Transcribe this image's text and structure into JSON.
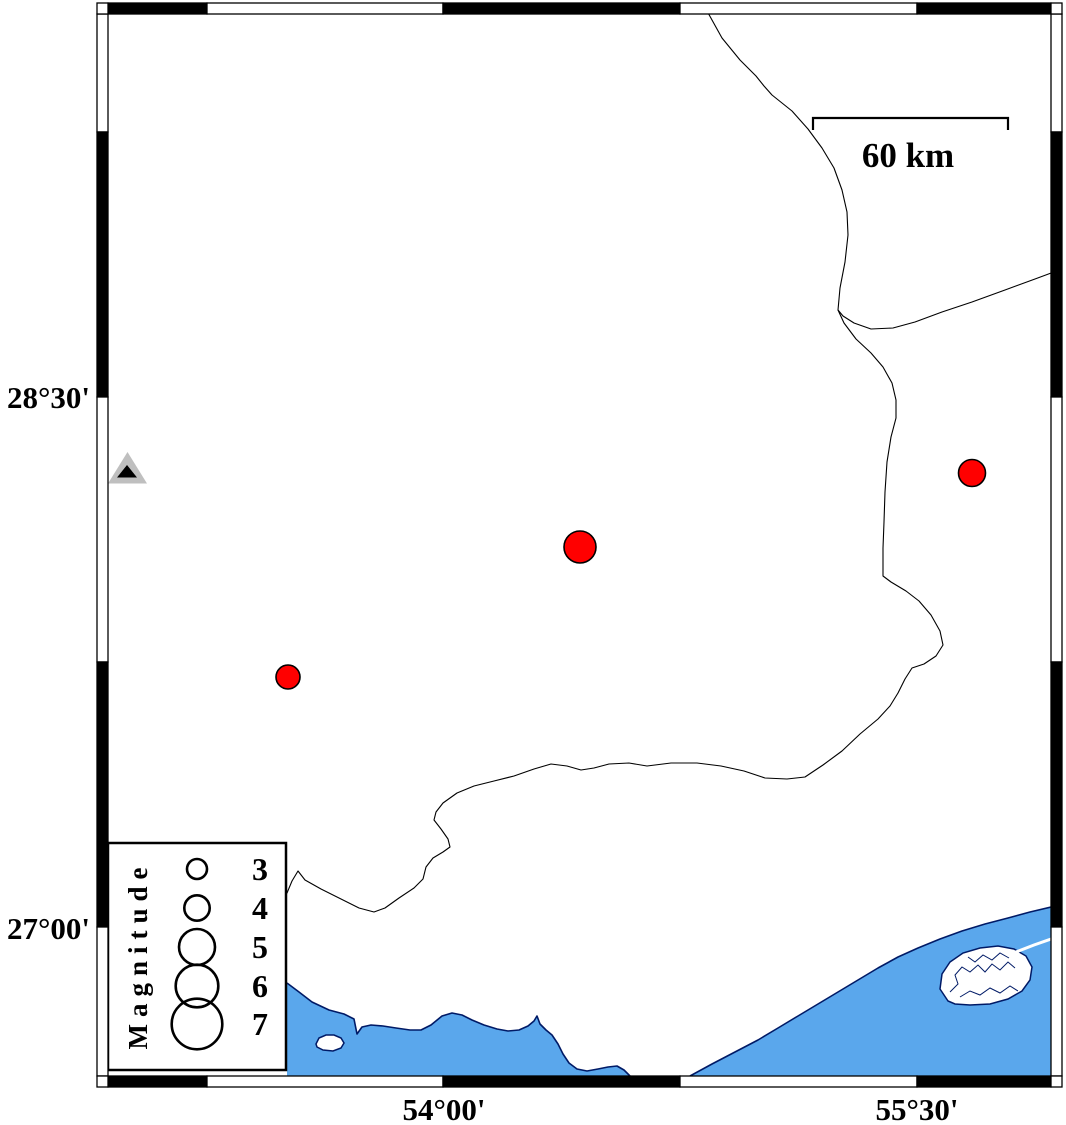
{
  "figure": {
    "width": 1066,
    "height": 1125,
    "background": "#FFFFFF"
  },
  "axis": {
    "lat_labels": [
      {
        "text": "28°30'"
      },
      {
        "text": "27°00'"
      }
    ],
    "lon_labels": [
      {
        "text": "54°00'"
      },
      {
        "text": "55°30'"
      }
    ]
  },
  "scalebar": {
    "label": "60 km"
  },
  "legend": {
    "title": "Magnitude",
    "circle_cx": 197,
    "label_x": 260,
    "entries": [
      {
        "label": "3",
        "cy": 869,
        "r": 10.0
      },
      {
        "label": "4",
        "cy": 908,
        "r": 12.7
      },
      {
        "label": "5",
        "cy": 947,
        "r": 18.0
      },
      {
        "label": "6",
        "cy": 986,
        "r": 21.3
      },
      {
        "label": "7",
        "cy": 1024,
        "r": 25.3
      }
    ]
  },
  "earthquakes": [
    {
      "x": 288,
      "y": 677,
      "r": 12.0
    },
    {
      "x": 580,
      "y": 547,
      "r": 16.0
    },
    {
      "x": 972,
      "y": 473,
      "r": 13.5
    }
  ],
  "station": {
    "x": 127.5,
    "y": 471
  },
  "colors": {
    "sea": "#5AA7EC",
    "coast_outline": "#001A66",
    "earthquake_fill": "#FF0000",
    "earthquake_stroke": "#000000",
    "station_gray": "#BFBFBF",
    "station_black": "#000000",
    "frame_black": "#000000",
    "frame_white": "#FFFFFF"
  },
  "frame": {
    "x_bounds": [
      108,
      207,
      443,
      680,
      917,
      1051
    ],
    "x_colors": [
      "black",
      "white",
      "black",
      "white",
      "black"
    ],
    "y_bounds": [
      14,
      132,
      397,
      662,
      927,
      1076
    ],
    "y_colors": [
      "white",
      "black",
      "white",
      "black",
      "white"
    ],
    "band": {
      "outer_left": 97,
      "inner_left": 108,
      "outer_top": 3,
      "inner_top": 14,
      "inner_right": 1051,
      "outer_right": 1062,
      "inner_bottom": 1076,
      "outer_bottom": 1087
    }
  },
  "paths": {
    "border_main": "M 707 11 L 722 38 L 740 60 L 756 76 L 764 86 L 772 95 L 792 111 L 808 129 L 822 148 L 834 168 L 842 190 L 847 212 L 848 235 L 845 262 L 840 288 L 838 310 L 844 323 L 856 339 L 871 353 L 883 367 L 892 383 L 896 400 L 896 418 L 891 437 L 887 462 L 885 492 L 884 522 L 883 548 L 883 576 L 891 582 L 906 591 L 919 601 L 931 615 L 940 631 L 943 645 L 936 656 L 924 664 L 912 668 L 905 679 L 898 693 L 890 706 L 878 719 L 860 734 L 842 751 L 823 765 L 805 777 L 787 779 L 765 778 L 744 771 L 721 766 L 697 763 L 671 763 L 647 766 L 629 763 L 609 764 L 594 768 L 581 770 L 567 766 L 551 764 L 534 769 L 514 776 L 494 781 L 474 786 L 457 793 L 443 803 L 436 812 L 434 820 L 441 829 L 448 839 L 450 847 L 443 852 L 433 858 L 426 867 L 423 879 L 414 888 L 399 898 L 385 908 L 374 912 L 359 908 L 341 899 L 321 889 L 305 880 L 298 871 L 292 881 L 287 893 L 283 890",
    "border_east": "M 1062 269 L 1035 279 L 1005 290 L 972 302 L 942 312 L 915 322 L 893 328 L 871 329 L 854 323 L 843 316 L 838 310",
    "sea_left": "M 287 983 L 299 992 L 312 1002 L 329 1010 L 344 1014 L 354 1019 L 357 1034 L 362 1027 L 371 1025 L 383 1026 L 396 1028 L 410 1030 L 421 1030 L 431 1025 L 442 1016 L 452 1013 L 462 1015 L 472 1020 L 484 1025 L 497 1029 L 508 1031 L 519 1030 L 528 1026 L 534 1021 L 537 1016 L 540 1024 L 546 1030 L 552 1035 L 558 1044 L 563 1054 L 569 1063 L 577 1069 L 587 1071 L 598 1069 L 608 1067 L 617 1066 L 624 1070 L 630 1076 L 287 1076 Z",
    "coast_left": "M 287 983 L 299 992 L 312 1002 L 329 1010 L 344 1014 L 354 1019 L 357 1034 L 362 1027 L 371 1025 L 383 1026 L 396 1028 L 410 1030 L 421 1030 L 431 1025 L 442 1016 L 452 1013 L 462 1015 L 472 1020 L 484 1025 L 497 1029 L 508 1031 L 519 1030 L 528 1026 L 534 1021 L 537 1016 L 540 1024 L 546 1030 L 552 1035 L 558 1044 L 563 1054 L 569 1063 L 577 1069 L 587 1071 L 598 1069 L 608 1067 L 617 1066 L 624 1070 L 630 1076",
    "island_left": "M 316 1044 L 319 1038 L 326 1035 L 334 1035 L 341 1038 L 344 1043 L 341 1048 L 333 1051 L 323 1050 L 317 1047 Z",
    "sea_right": "M 690 1076 L 712 1064 L 735 1052 L 758 1040 L 778 1028 L 798 1016 L 818 1004 L 838 992 L 858 980 L 878 968 L 898 957 L 918 948 L 940 939 L 962 931 L 985 924 L 1008 918 L 1030 912 L 1051 907 L 1051 1076 Z",
    "coast_right": "M 690 1076 L 712 1064 L 735 1052 L 758 1040 L 778 1028 L 798 1016 L 818 1004 L 838 992 L 858 980 L 878 968 L 898 957 L 918 948 L 940 939 L 962 931 L 985 924 L 1008 918 L 1030 912 L 1051 907",
    "island_right": "M 948 1001 L 940 989 L 942 974 L 950 962 L 963 953 L 980 948 L 998 946 L 1014 949 L 1026 956 L 1032 967 L 1030 980 L 1022 991 L 1008 999 L 990 1004 L 970 1005 L 955 1004 Z",
    "channel": "M 1051 939 L 1034 945 L 1016 952",
    "squiggle1": "M 950 992 L 958 984 L 955 975 L 962 967 L 970 972 L 978 965 L 985 972 L 992 964 L 1000 970 L 1008 962 L 1015 968",
    "squiggle2": "M 960 997 L 970 991 L 980 995 L 990 988 L 1000 993 L 1010 986 L 1018 991",
    "squiggle3": "M 968 957 L 975 962 L 983 955 L 992 960 L 1000 953 L 1009 958",
    "scalebar": "M 813 130 L 813 118 L 1008 118 L 1008 130"
  }
}
